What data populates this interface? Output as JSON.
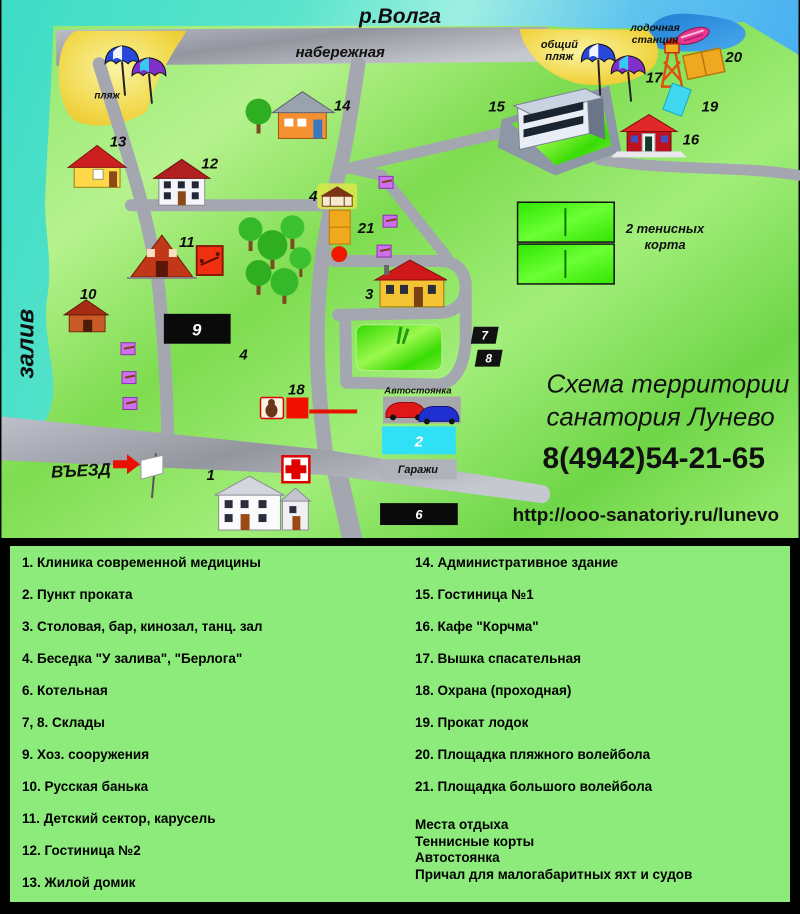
{
  "map": {
    "labels": {
      "river": "р.Волга",
      "embankment": "набережная",
      "beach": "пляж",
      "public_beach_1": "общий",
      "public_beach_2": "пляж",
      "boat_station_1": "лодочная",
      "boat_station_2": "станция",
      "bay": "залив",
      "entrance": "ВЪЕЗД",
      "tennis_1": "2 тенисных",
      "tennis_2": "корта",
      "parking": "Автостоянка",
      "garages": "Гаражи"
    },
    "markers": {
      "m1": "1",
      "m2": "2",
      "m3": "3",
      "m4a": "4",
      "m4b": "4",
      "m6": "6",
      "m7": "7",
      "m8": "8",
      "m9": "9",
      "m10": "10",
      "m11": "11",
      "m12": "12",
      "m13": "13",
      "m14": "14",
      "m15": "15",
      "m16": "16",
      "m17": "17",
      "m18": "18",
      "m19": "19",
      "m20": "20",
      "m21": "21"
    },
    "info": {
      "title_line1": "Схема территории",
      "title_line2": "санатория Лунево",
      "phone": "8(4942)54-21-65",
      "url": "http://ooo-sanatoriy.ru/lunevo"
    },
    "colors": {
      "water_teal": "#3edcc6",
      "water_blue": "#47aef2",
      "land_green": "#86e45f",
      "road_gray": "#a4a6b0",
      "beach_yellow": "#f2d94e",
      "lawn_green": "#52ea18",
      "court_green": "#3ce80a",
      "legend_bg": "#8ceb7a",
      "accent_red": "#e81000",
      "pool_cyan": "#35dff2",
      "volleyball_orange": "#f0a820"
    }
  },
  "legend": {
    "left_items": [
      "1. Клиника современной медицины",
      "2. Пункт проката",
      "3. Столовая, бар, кинозал, танц. зал",
      "4. Беседка \"У залива\", \"Берлога\"",
      "6. Котельная",
      "7, 8. Склады",
      "9. Хоз. сооружения",
      "10. Русская банька",
      "11. Детский сектор, карусель",
      "12. Гостиница №2",
      "13. Жилой домик"
    ],
    "right_items": [
      "14. Административное здание",
      "15. Гостиница №1",
      "16. Кафе \"Корчма\"",
      "17. Вышка спасательная",
      "18. Охрана (проходная)",
      "19. Прокат лодок",
      "20. Площадка пляжного волейбола",
      "21. Площадка большого волейбола"
    ],
    "extra_items": [
      "Места отдыха",
      "Теннисные корты",
      "Автостоянка",
      "Причал для малогабаритных яхт и судов"
    ]
  }
}
